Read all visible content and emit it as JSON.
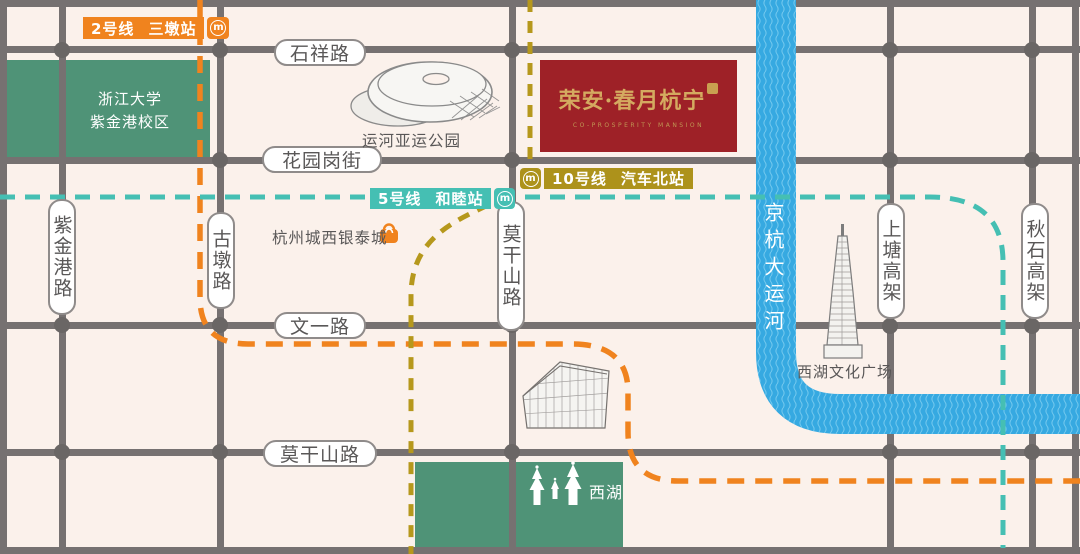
{
  "project": {
    "title": "荣安·春月杭宁",
    "subtitle": "CO-PROSPERITY MANSION"
  },
  "metro": {
    "logo_glyph": "m",
    "line2": {
      "line_no": "2号线",
      "station": "三墩站",
      "color": "#F0831E"
    },
    "line5": {
      "line_no": "5号线",
      "station": "和睦站",
      "color": "#45BFB3"
    },
    "line10": {
      "line_no": "10号线",
      "station": "汽车北站",
      "color": "#AD921B"
    }
  },
  "road_labels": [
    {
      "text": "石祥路"
    },
    {
      "text": "花园岗街"
    },
    {
      "text": "文一路"
    },
    {
      "text": "莫干山路"
    },
    {
      "text": "紫金港路"
    },
    {
      "text": "古墩路"
    },
    {
      "text": "莫干山路"
    },
    {
      "text": "上塘高架"
    },
    {
      "text": "秋石高架"
    }
  ],
  "areas": {
    "campus_line1": "浙江大学",
    "campus_line2": "紫金港校区",
    "west_lake": "西湖"
  },
  "pois": {
    "canal_park": "运河亚运公园",
    "yintai_mall": "杭州城西银泰城",
    "culture_square": "西湖文化广场"
  },
  "river": {
    "name": "京杭大运河"
  },
  "colors": {
    "background": "#FBF1EB",
    "road": "#767171",
    "junction_dot": "#6A6665",
    "river_blue": "#36A9E1",
    "area_green": "#4F9377",
    "banner_red": "#9E2127",
    "banner_gold": "#D4AA60",
    "line2_orange": "#F0831E",
    "line5_teal": "#45BFB3",
    "line10_gold": "#AD921B",
    "label_text": "#595757"
  }
}
